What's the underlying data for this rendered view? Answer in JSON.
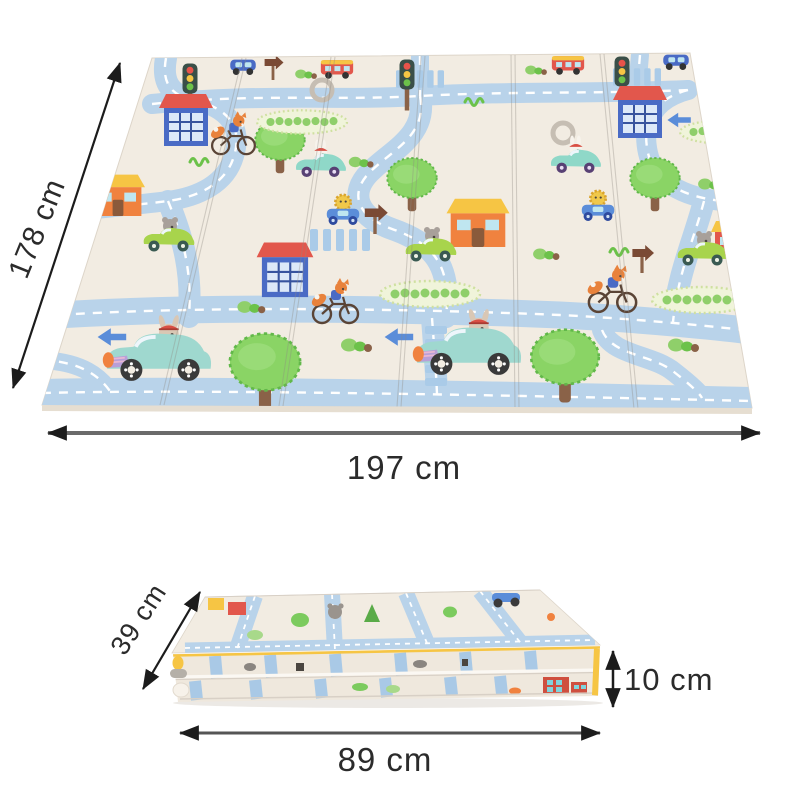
{
  "annotations": {
    "unfolded_height": "178 cm",
    "unfolded_width": "197 cm",
    "folded_depth": "39 cm",
    "folded_thickness": "10 cm",
    "folded_width": "89 cm"
  },
  "product": {
    "type": "foldable baby play mat",
    "views": {
      "unfolded": "unfolded mat shown in perspective with fold creases",
      "folded": "mat folded into a flat stack, side view"
    },
    "pattern": {
      "theme": "toy town roads with animal drivers",
      "elements": [
        "road",
        "crosswalk",
        "traffic-light",
        "blue-house",
        "orange-house",
        "red-house",
        "tree",
        "hedge",
        "bush",
        "fox-on-bicycle",
        "mouse-in-green-car",
        "bunny-in-teal-car",
        "lion-in-blue-car",
        "animal-in-race-car",
        "toy-car",
        "bus",
        "direction-sign",
        "road-arrow",
        "roundabout"
      ],
      "colors": {
        "mat_base": "#f2ece2",
        "road": "#b9d3ea",
        "road_dash": "#ffffff",
        "tree_green": "#8ad465",
        "house_red": "#e2574c",
        "house_blue": "#4a6bc5",
        "house_orange": "#f0823f",
        "roof_yellow": "#f6c544",
        "fox_orange": "#e8823c",
        "folded_edge_yellow": "#f6c544"
      }
    }
  },
  "annotation_style": {
    "arrow_color": "#2b2b2b",
    "secondary_line_color": "#6b6b6b",
    "text_color": "#2b2b2b"
  }
}
